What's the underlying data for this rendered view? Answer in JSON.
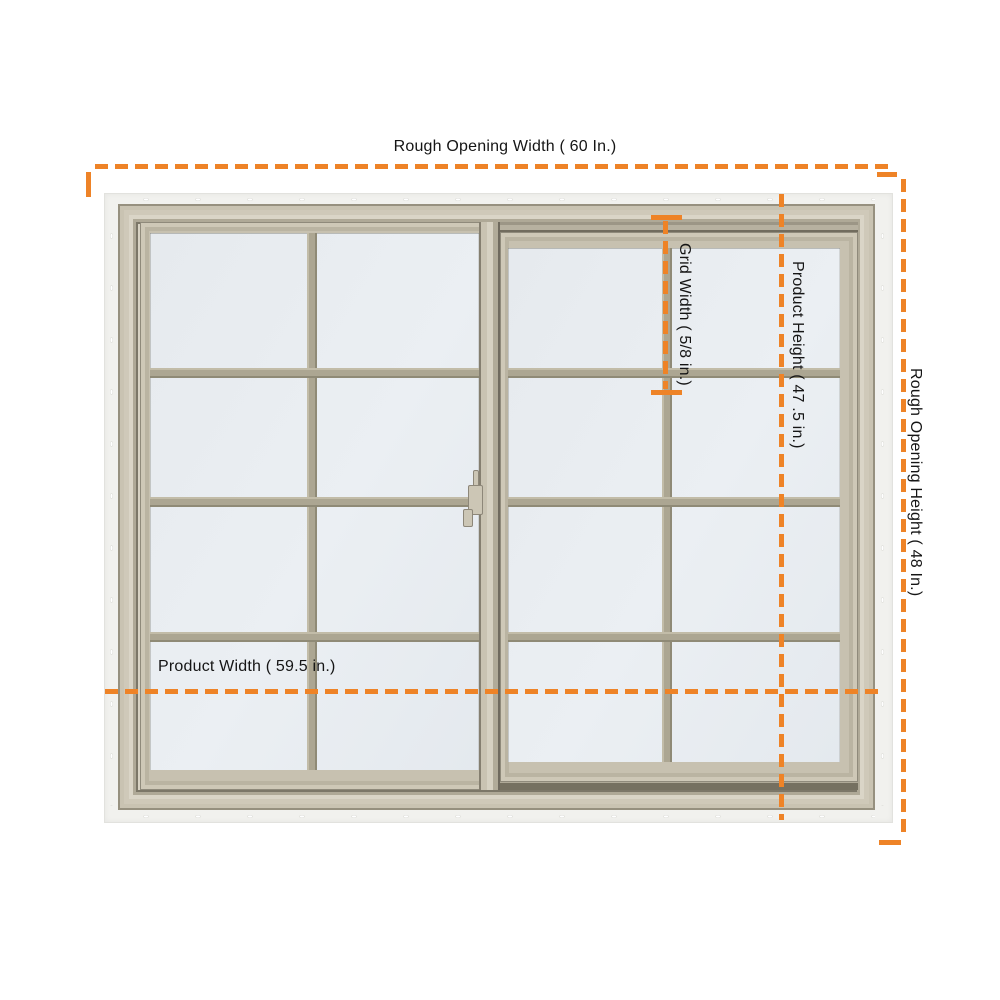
{
  "diagram": {
    "title": "Sliding window rough-opening dimension diagram",
    "annotations": {
      "rough_opening_width": "Rough Opening Width ( 60 In.)",
      "rough_opening_height": "Rough Opening Height ( 48 In.)",
      "product_width": "Product Width ( 59.5 in.)",
      "product_height": "Product Height ( 47 .5 in.)",
      "grid_width": "Grid Width ( 5/8 in.)"
    },
    "values": {
      "rough_opening_width_in": 60,
      "rough_opening_height_in": 48,
      "product_width_in": 59.5,
      "product_height_in": 47.5,
      "grid_width_in": "5/8"
    },
    "window": {
      "type": "horizontal slider, 2 sashes",
      "grid_pattern": "colonial",
      "lites_per_sash": "2 wide x 4 high",
      "has_nailing_flange": true,
      "latch": "center meeting-rail latch"
    },
    "colors": {
      "dimension_line": "#EE8327",
      "label_text": "#151515",
      "frame_tan": "#C6C0AF",
      "grid_bar": "#ACA692",
      "glass": "#E9EDF2",
      "nail_fin": "#F1F1EE",
      "background": "#FFFFFF"
    }
  }
}
